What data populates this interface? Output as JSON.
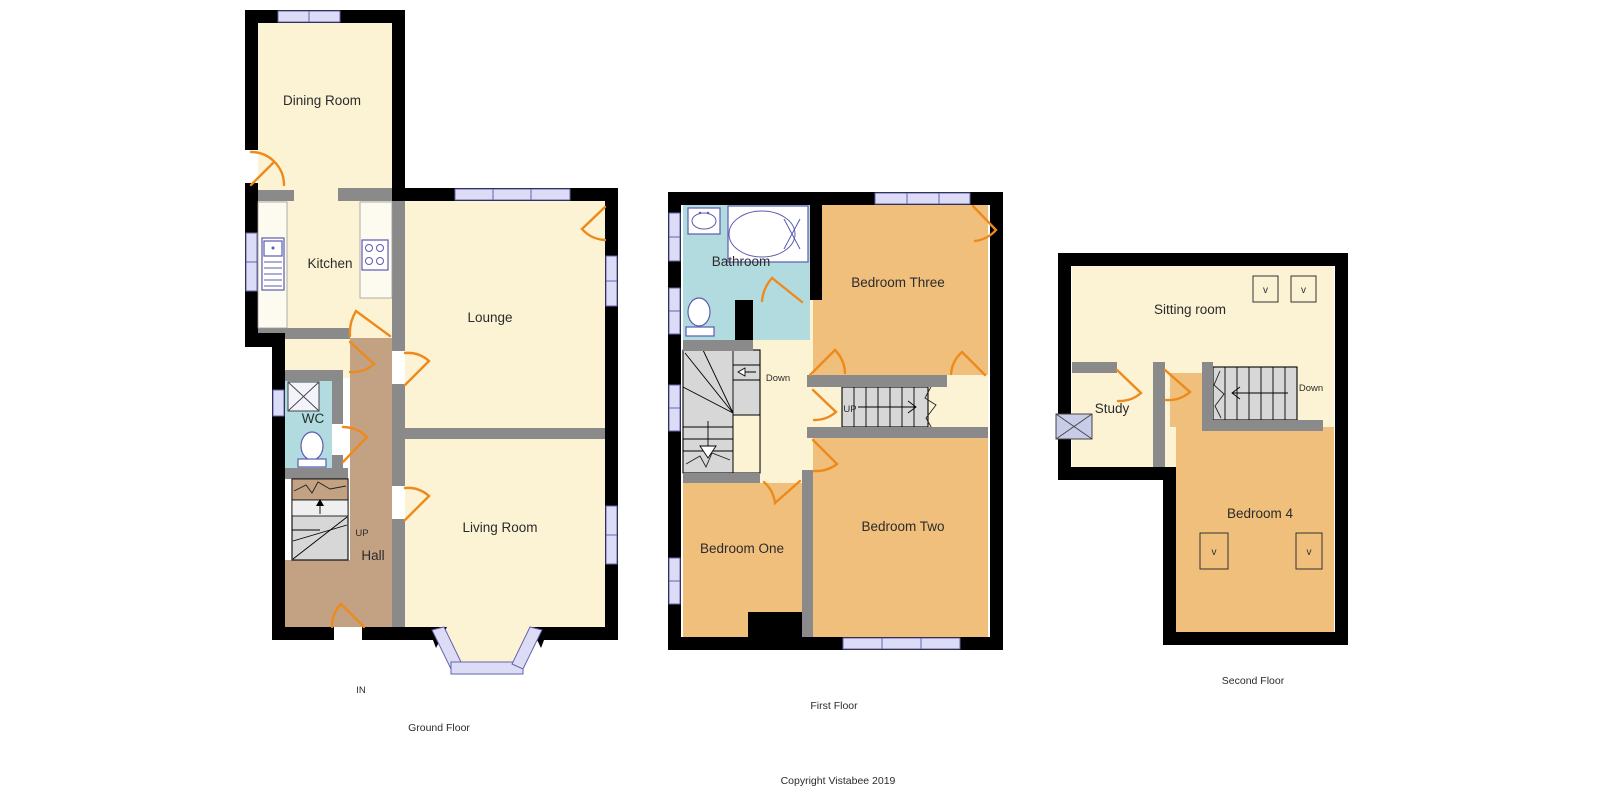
{
  "colors": {
    "wall": "#000000",
    "partition": "#8a8a8a",
    "room_cream": "#fcf3d4",
    "room_orange": "#efbf7b",
    "room_blue": "#b2dbe0",
    "hall_brown": "#c3a284",
    "window": "#dcdcf6",
    "window_border": "#6363ae",
    "door_arc": "#ee8a1c",
    "stairs": "#d7d7d7"
  },
  "ground_floor": {
    "caption": "Ground Floor",
    "rooms": {
      "dining_room": "Dining Room",
      "kitchen": "Kitchen",
      "lounge": "Lounge",
      "wc": "WC",
      "hall": "Hall",
      "living_room": "Living Room"
    },
    "labels": {
      "up": "UP",
      "in": "IN"
    }
  },
  "first_floor": {
    "caption": "First Floor",
    "rooms": {
      "bathroom": "Bathroom",
      "bedroom_three": "Bedroom Three",
      "bedroom_one": "Bedroom One",
      "bedroom_two": "Bedroom Two"
    },
    "labels": {
      "down": "Down",
      "up": "UP"
    }
  },
  "second_floor": {
    "caption": "Second Floor",
    "rooms": {
      "sitting_room": "Sitting room",
      "study": "Study",
      "bedroom_four": "Bedroom 4"
    },
    "labels": {
      "down": "Down",
      "velux": "v"
    }
  },
  "footer": {
    "copyright": "Copyright Vistabee 2019"
  }
}
